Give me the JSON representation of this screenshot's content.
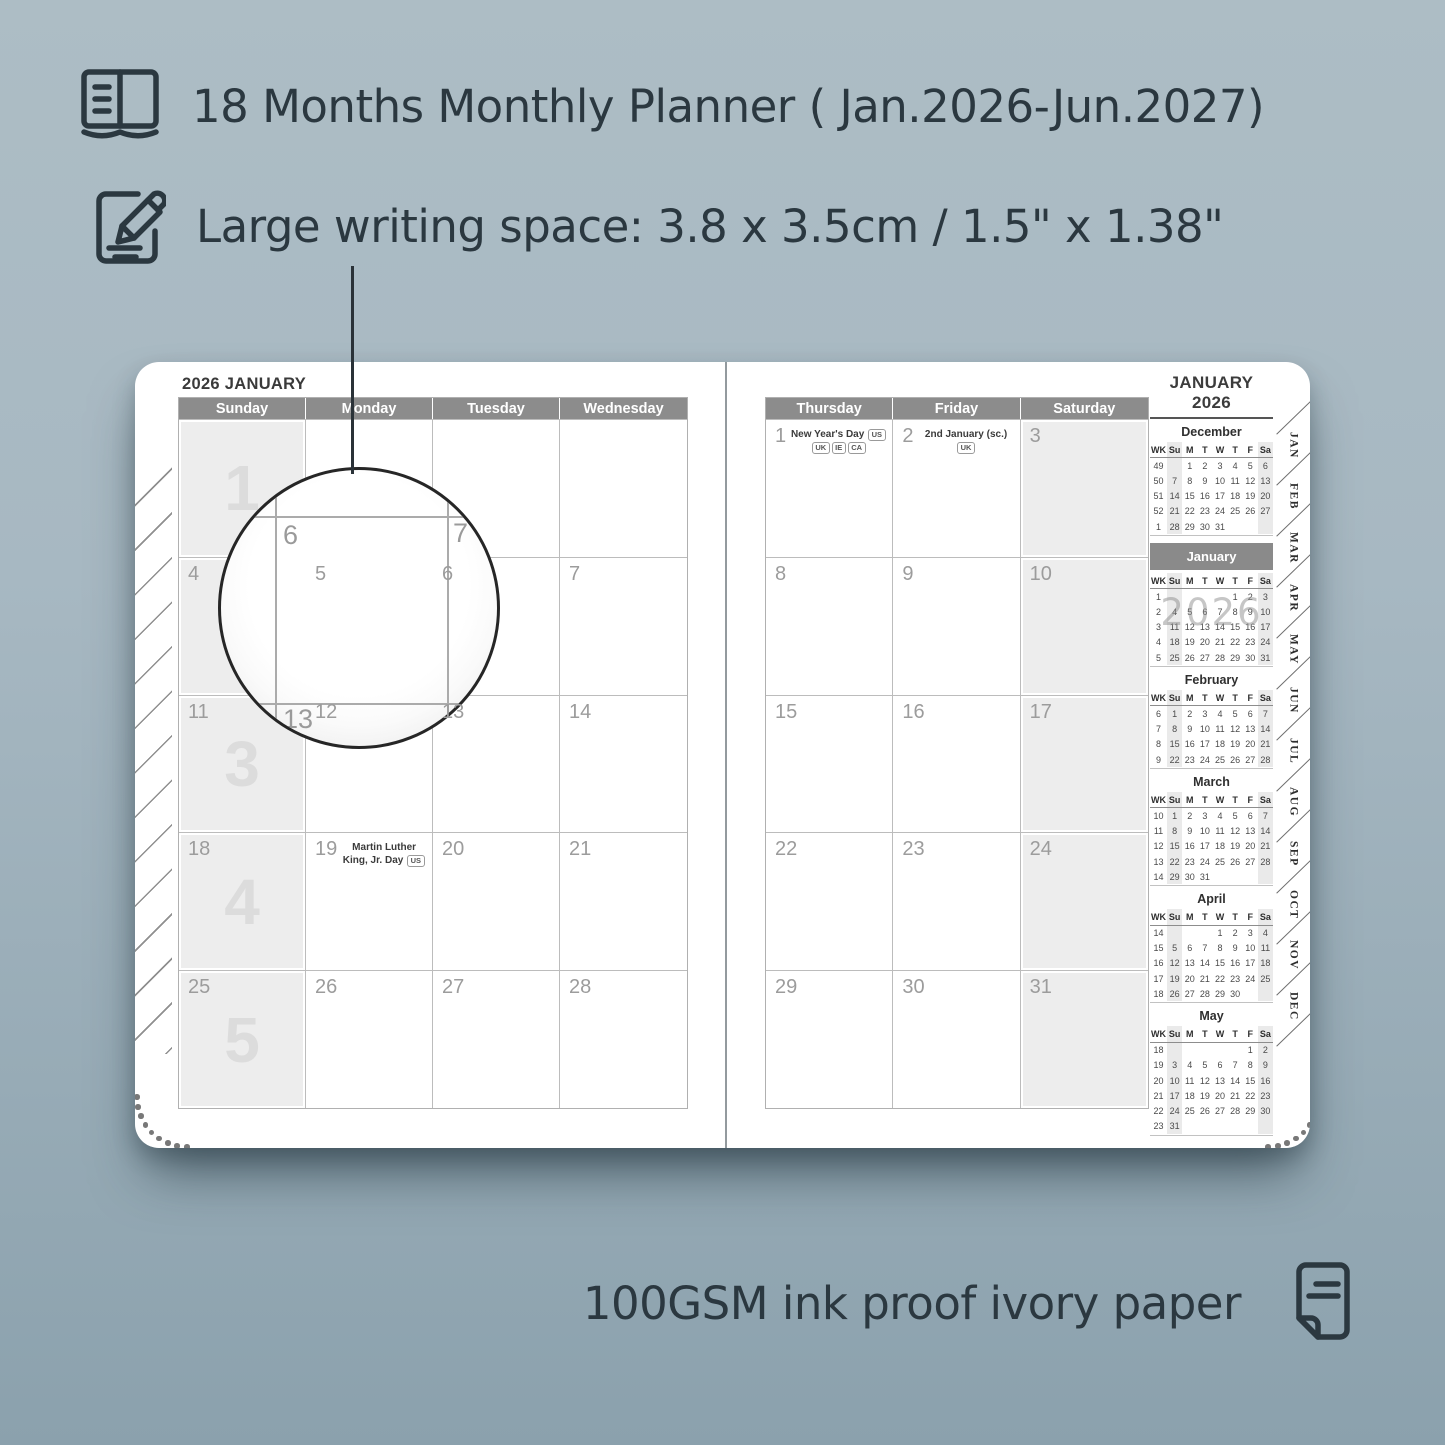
{
  "colors": {
    "background": "#a4b6c0",
    "ink": "#2b3840",
    "day_header_bar": "#8c8c8c",
    "weekend_shade": "#ededed",
    "highlight_bar": "#8a8a8a",
    "page": "#ffffff"
  },
  "features": {
    "line1": "18 Months Monthly Planner ( Jan.2026-Jun.2027)",
    "line2": "Large writing space: 3.8 x 3.5cm / 1.5\" x 1.38\"",
    "footer": "100GSM ink proof ivory paper"
  },
  "icons": {
    "feature1": "notebook-icon",
    "feature2": "pencil-note-icon",
    "footer": "paper-icon"
  },
  "left_page": {
    "title": "2026 JANUARY",
    "day_headers": [
      "Sunday",
      "Monday",
      "Tuesday",
      "Wednesday"
    ],
    "weeks": [
      {
        "watermark": "1",
        "cells": [
          {
            "d": ""
          },
          {
            "d": ""
          },
          {
            "d": ""
          },
          {
            "d": ""
          }
        ]
      },
      {
        "watermark": "2",
        "cells": [
          {
            "d": "4"
          },
          {
            "d": "5"
          },
          {
            "d": "6"
          },
          {
            "d": "7"
          }
        ]
      },
      {
        "watermark": "3",
        "cells": [
          {
            "d": "11"
          },
          {
            "d": "12"
          },
          {
            "d": "13"
          },
          {
            "d": "14"
          }
        ]
      },
      {
        "watermark": "4",
        "cells": [
          {
            "d": "18"
          },
          {
            "d": "19",
            "holiday": "Martin Luther King, Jr. Day",
            "tags": [
              "US"
            ]
          },
          {
            "d": "20"
          },
          {
            "d": "21"
          }
        ]
      },
      {
        "watermark": "5",
        "cells": [
          {
            "d": "25"
          },
          {
            "d": "26"
          },
          {
            "d": "27"
          },
          {
            "d": "28"
          }
        ]
      }
    ]
  },
  "right_page": {
    "title": "JANUARY 2026",
    "day_headers": [
      "Thursday",
      "Friday",
      "Saturday"
    ],
    "weeks": [
      {
        "cells": [
          {
            "d": "1",
            "holiday": "New Year's Day",
            "tags": [
              "US",
              "UK",
              "IE",
              "CA"
            ]
          },
          {
            "d": "2",
            "holiday": "2nd January (sc.)",
            "tags": [
              "UK"
            ]
          },
          {
            "d": "3"
          }
        ]
      },
      {
        "cells": [
          {
            "d": "8"
          },
          {
            "d": "9"
          },
          {
            "d": "10"
          }
        ]
      },
      {
        "cells": [
          {
            "d": "15"
          },
          {
            "d": "16"
          },
          {
            "d": "17"
          }
        ]
      },
      {
        "cells": [
          {
            "d": "22"
          },
          {
            "d": "23"
          },
          {
            "d": "24"
          }
        ]
      },
      {
        "cells": [
          {
            "d": "29"
          },
          {
            "d": "30"
          },
          {
            "d": "31"
          }
        ]
      }
    ]
  },
  "mini_calendars": {
    "columns": [
      "WK",
      "Su",
      "M",
      "T",
      "W",
      "T",
      "F",
      "Sa"
    ],
    "months": [
      {
        "name": "December",
        "rows": [
          [
            "49",
            "",
            "1",
            "2",
            "3",
            "4",
            "5",
            "6"
          ],
          [
            "50",
            "7",
            "8",
            "9",
            "10",
            "11",
            "12",
            "13"
          ],
          [
            "51",
            "14",
            "15",
            "16",
            "17",
            "18",
            "19",
            "20"
          ],
          [
            "52",
            "21",
            "22",
            "23",
            "24",
            "25",
            "26",
            "27"
          ],
          [
            "1",
            "28",
            "29",
            "30",
            "31",
            "",
            "",
            ""
          ]
        ]
      },
      {
        "name": "January",
        "highlight": true,
        "watermark": "2026",
        "rows": [
          [
            "1",
            "",
            "",
            "",
            "",
            "1",
            "2",
            "3"
          ],
          [
            "2",
            "4",
            "5",
            "6",
            "7",
            "8",
            "9",
            "10"
          ],
          [
            "3",
            "11",
            "12",
            "13",
            "14",
            "15",
            "16",
            "17"
          ],
          [
            "4",
            "18",
            "19",
            "20",
            "21",
            "22",
            "23",
            "24"
          ],
          [
            "5",
            "25",
            "26",
            "27",
            "28",
            "29",
            "30",
            "31"
          ]
        ]
      },
      {
        "name": "February",
        "rows": [
          [
            "6",
            "1",
            "2",
            "3",
            "4",
            "5",
            "6",
            "7"
          ],
          [
            "7",
            "8",
            "9",
            "10",
            "11",
            "12",
            "13",
            "14"
          ],
          [
            "8",
            "15",
            "16",
            "17",
            "18",
            "19",
            "20",
            "21"
          ],
          [
            "9",
            "22",
            "23",
            "24",
            "25",
            "26",
            "27",
            "28"
          ]
        ]
      },
      {
        "name": "March",
        "rows": [
          [
            "10",
            "1",
            "2",
            "3",
            "4",
            "5",
            "6",
            "7"
          ],
          [
            "11",
            "8",
            "9",
            "10",
            "11",
            "12",
            "13",
            "14"
          ],
          [
            "12",
            "15",
            "16",
            "17",
            "18",
            "19",
            "20",
            "21"
          ],
          [
            "13",
            "22",
            "23",
            "24",
            "25",
            "26",
            "27",
            "28"
          ],
          [
            "14",
            "29",
            "30",
            "31",
            "",
            "",
            "",
            ""
          ]
        ]
      },
      {
        "name": "April",
        "rows": [
          [
            "14",
            "",
            "",
            "",
            "1",
            "2",
            "3",
            "4"
          ],
          [
            "15",
            "5",
            "6",
            "7",
            "8",
            "9",
            "10",
            "11"
          ],
          [
            "16",
            "12",
            "13",
            "14",
            "15",
            "16",
            "17",
            "18"
          ],
          [
            "17",
            "19",
            "20",
            "21",
            "22",
            "23",
            "24",
            "25"
          ],
          [
            "18",
            "26",
            "27",
            "28",
            "29",
            "30",
            "",
            ""
          ]
        ]
      },
      {
        "name": "May",
        "rows": [
          [
            "18",
            "",
            "",
            "",
            "",
            "",
            "1",
            "2"
          ],
          [
            "19",
            "3",
            "4",
            "5",
            "6",
            "7",
            "8",
            "9"
          ],
          [
            "20",
            "10",
            "11",
            "12",
            "13",
            "14",
            "15",
            "16"
          ],
          [
            "21",
            "17",
            "18",
            "19",
            "20",
            "21",
            "22",
            "23"
          ],
          [
            "22",
            "24",
            "25",
            "26",
            "27",
            "28",
            "29",
            "30"
          ],
          [
            "23",
            "31",
            "",
            "",
            "",
            "",
            "",
            ""
          ]
        ]
      }
    ]
  },
  "tabs": [
    "JAN",
    "FEB",
    "MAR",
    "APR",
    "MAY",
    "JUN",
    "JUL",
    "AUG",
    "SEP",
    "OCT",
    "NOV",
    "DEC"
  ],
  "magnifier": {
    "numbers": [
      "6",
      "7",
      "13"
    ]
  }
}
